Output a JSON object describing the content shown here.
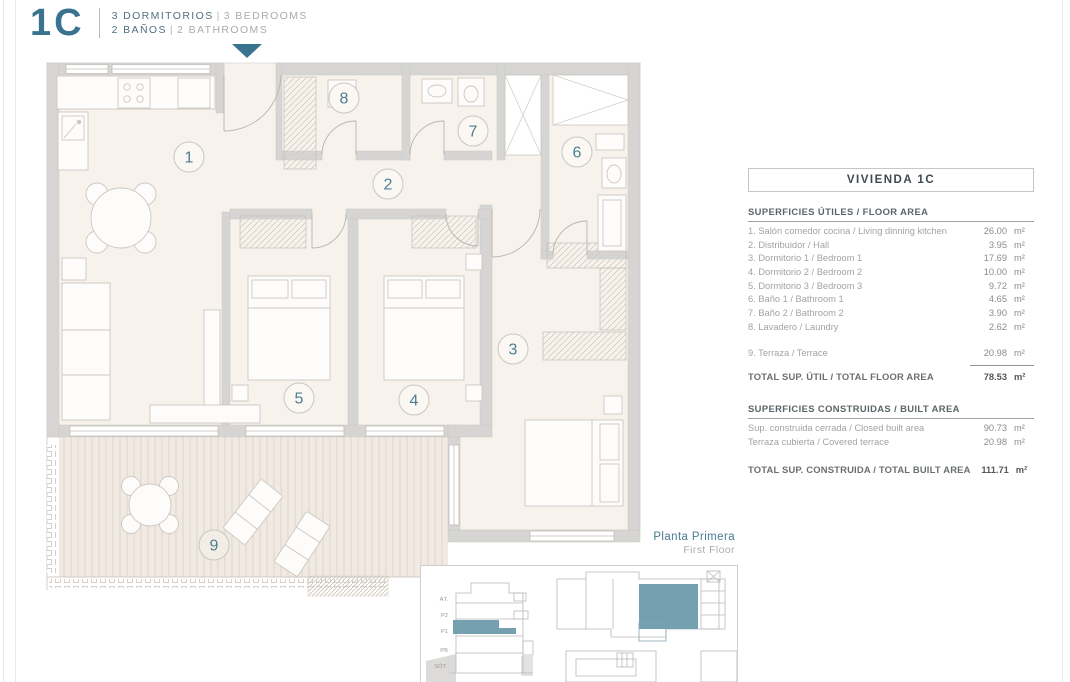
{
  "header": {
    "unit": "1C",
    "rooms_es": "3 DORMITORIOS",
    "rooms_en": "3 BEDROOMS",
    "baths_es": "2 BAÑOS",
    "baths_en": "2 BATHROOMS",
    "sep": "|"
  },
  "plan": {
    "rooms": [
      {
        "number": "1",
        "name": "living-dining-kitchen"
      },
      {
        "number": "2",
        "name": "hall"
      },
      {
        "number": "3",
        "name": "bedroom-1"
      },
      {
        "number": "4",
        "name": "bedroom-2"
      },
      {
        "number": "5",
        "name": "bedroom-3"
      },
      {
        "number": "6",
        "name": "bathroom-1"
      },
      {
        "number": "7",
        "name": "bathroom-2"
      },
      {
        "number": "8",
        "name": "laundry"
      },
      {
        "number": "9",
        "name": "terrace"
      }
    ]
  },
  "table": {
    "title": "VIVIENDA 1C",
    "useful": {
      "heading": "SUPERFICIES ÚTILES / FLOOR AREA",
      "rows": [
        {
          "label": "1. Salón comedor cocina / Living dinning kitchen",
          "value": "26.00",
          "unit": "m²"
        },
        {
          "label": "2. Distribuidor / Hall",
          "value": "3.95",
          "unit": "m²"
        },
        {
          "label": "3. Dormitorio 1 / Bedroom 1",
          "value": "17.69",
          "unit": "m²"
        },
        {
          "label": "4. Dormitorio 2 / Bedroom 2",
          "value": "10.00",
          "unit": "m²"
        },
        {
          "label": "5. Dormitorio 3 / Bedroom 3",
          "value": "9.72",
          "unit": "m²"
        },
        {
          "label": "6. Baño 1 / Bathroom 1",
          "value": "4.65",
          "unit": "m²"
        },
        {
          "label": "7. Baño 2 / Bathroom 2",
          "value": "3.90",
          "unit": "m²"
        },
        {
          "label": "8. Lavadero / Laundry",
          "value": "2.62",
          "unit": "m²"
        }
      ],
      "terrace_row": {
        "label": "9. Terraza / Terrace",
        "value": "20.98",
        "unit": "m²"
      },
      "total": {
        "label": "TOTAL SUP. ÚTIL / TOTAL FLOOR AREA",
        "value": "78.53",
        "unit": "m²"
      }
    },
    "built": {
      "heading": "SUPERFICIES CONSTRUIDAS / BUILT AREA",
      "rows": [
        {
          "label": "Sup. construida cerrada / Closed built area",
          "value": "90.73",
          "unit": "m²"
        },
        {
          "label": "Terraza cubierta / Covered terrace",
          "value": "20.98",
          "unit": "m²"
        }
      ],
      "total": {
        "label": "TOTAL SUP. CONSTRUIDA / TOTAL BUILT AREA",
        "value": "111.71",
        "unit": "m²"
      }
    }
  },
  "locator": {
    "floor_title_es": "Planta Primera",
    "floor_title_en": "First Floor",
    "floors": [
      {
        "label": "ÁT."
      },
      {
        "label": "P2"
      },
      {
        "label": "P1"
      },
      {
        "label": "PB"
      },
      {
        "label": "SÓT."
      }
    ]
  },
  "colors": {
    "accent_teal": "#3a7390",
    "room_number_teal": "#4b7e91",
    "locator_highlight": "#74a0af",
    "wall_gray": "#d6d5d3",
    "floor_beige": "#f7f2ec"
  }
}
